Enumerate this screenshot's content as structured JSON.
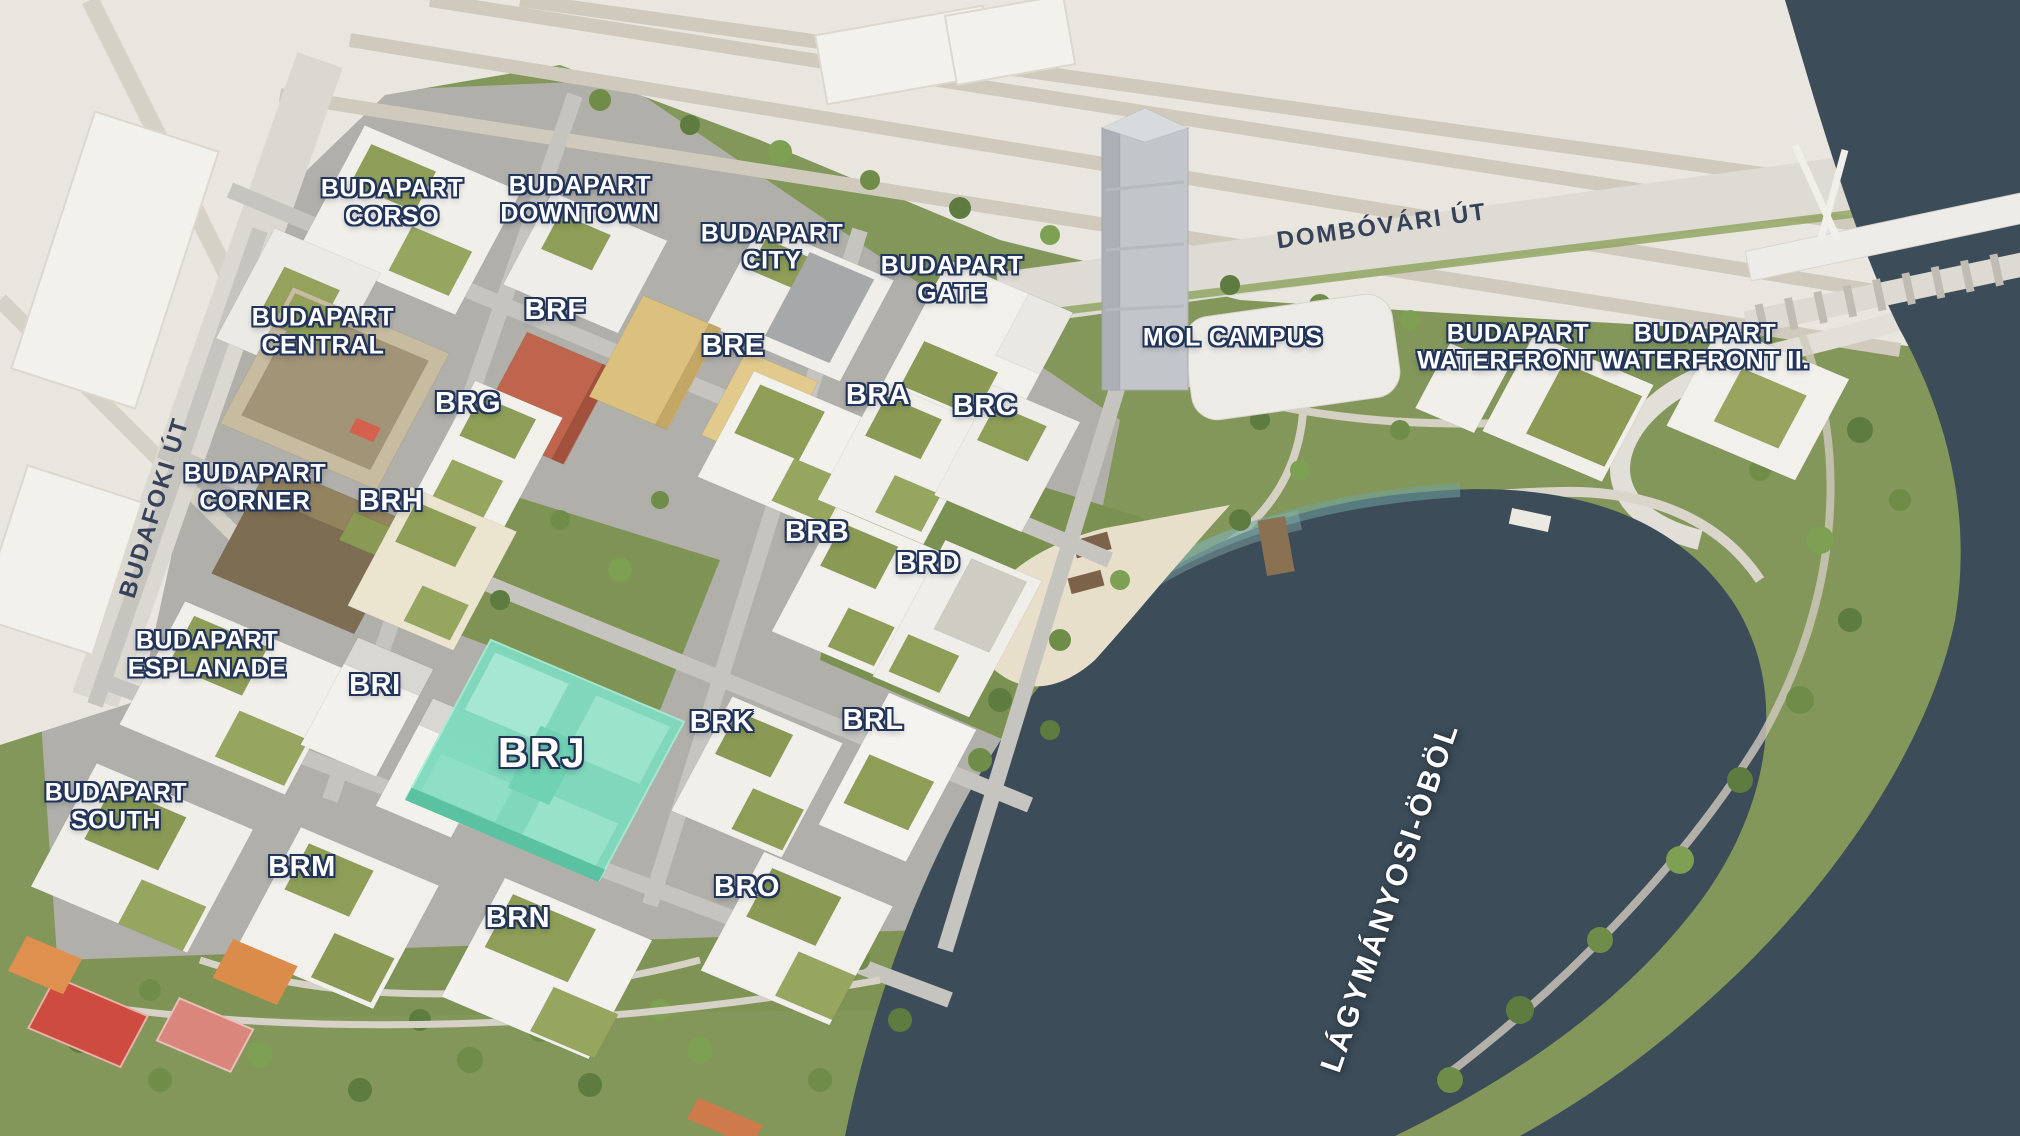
{
  "scene": {
    "type": "aerial-3d-masterplan-render",
    "development": "BudaPart",
    "highlighted_block": "BRJ",
    "colors": {
      "highlight_building": "#7edabd",
      "water": "#3c4c59",
      "park_green": "#83975a",
      "label_text": "#ffffff",
      "label_outline": "#22345a",
      "road_label_text": "#36425a",
      "sand_beach": "#e8dfca",
      "sport_court_red": "#ce4b3f"
    }
  },
  "labels": [
    {
      "id": "budapart-corso",
      "text": "BUDAPART CORSO",
      "lines": [
        "BUDAPART",
        "CORSO"
      ],
      "x_pct": 19.41,
      "y_pct": 17.87,
      "rot": 0,
      "type": "district"
    },
    {
      "id": "budapart-downtown",
      "text": "BUDAPART DOWNTOWN",
      "lines": [
        "BUDAPART",
        "DOWNTOWN"
      ],
      "x_pct": 28.71,
      "y_pct": 17.61,
      "rot": 0,
      "type": "district"
    },
    {
      "id": "budapart-city",
      "text": "BUDAPART CITY",
      "lines": [
        "BUDAPART",
        "CITY"
      ],
      "x_pct": 38.22,
      "y_pct": 21.83,
      "rot": 0,
      "type": "district"
    },
    {
      "id": "budapart-gate",
      "text": "BUDAPART GATE",
      "lines": [
        "BUDAPART",
        "GATE"
      ],
      "x_pct": 47.13,
      "y_pct": 24.65,
      "rot": 0,
      "type": "district"
    },
    {
      "id": "mol-campus",
      "text": "MOL CAMPUS",
      "lines": [
        "MOL CAMPUS"
      ],
      "x_pct": 61.04,
      "y_pct": 29.75,
      "rot": 0,
      "type": "landmark"
    },
    {
      "id": "budapart-waterfront-1",
      "text": "BUDAPART WATERFRONT I.",
      "lines": [
        "BUDAPART",
        "WATERFRONT I."
      ],
      "x_pct": 75.15,
      "y_pct": 30.63,
      "rot": 0,
      "type": "district"
    },
    {
      "id": "budapart-waterfront-2",
      "text": "BUDAPART WATERFRONT II.",
      "lines": [
        "BUDAPART",
        "WATERFRONT II."
      ],
      "x_pct": 84.41,
      "y_pct": 30.63,
      "rot": 0,
      "type": "district"
    },
    {
      "id": "dombovari-ut",
      "text": "DOMBÓVÁRI ÚT",
      "lines": [
        "DOMBÓVÁRI ÚT"
      ],
      "x_pct": 68.42,
      "y_pct": 19.98,
      "rot": -8,
      "type": "road"
    },
    {
      "id": "budafoki-ut",
      "text": "BUDAFOKI ÚT",
      "lines": [
        "BUDAFOKI ÚT"
      ],
      "x_pct": 7.67,
      "y_pct": 44.72,
      "rot": -73,
      "type": "road"
    },
    {
      "id": "budapart-central",
      "text": "BUDAPART CENTRAL",
      "lines": [
        "BUDAPART",
        "CENTRAL"
      ],
      "x_pct": 15.99,
      "y_pct": 29.23,
      "rot": 0,
      "type": "district"
    },
    {
      "id": "brf",
      "text": "BRF",
      "lines": [
        "BRF"
      ],
      "x_pct": 27.48,
      "y_pct": 27.38,
      "rot": 0,
      "type": "block"
    },
    {
      "id": "bre",
      "text": "BRE",
      "lines": [
        "BRE"
      ],
      "x_pct": 36.29,
      "y_pct": 30.55,
      "rot": 0,
      "type": "block"
    },
    {
      "id": "brg",
      "text": "BRG",
      "lines": [
        "BRG"
      ],
      "x_pct": 23.17,
      "y_pct": 35.56,
      "rot": 0,
      "type": "block"
    },
    {
      "id": "bra",
      "text": "BRA",
      "lines": [
        "BRA"
      ],
      "x_pct": 43.47,
      "y_pct": 34.86,
      "rot": 0,
      "type": "block"
    },
    {
      "id": "brc",
      "text": "BRC",
      "lines": [
        "BRC"
      ],
      "x_pct": 48.76,
      "y_pct": 35.83,
      "rot": 0,
      "type": "block"
    },
    {
      "id": "budapart-corner",
      "text": "BUDAPART CORNER",
      "lines": [
        "BUDAPART",
        "CORNER"
      ],
      "x_pct": 12.62,
      "y_pct": 42.96,
      "rot": 0,
      "type": "district"
    },
    {
      "id": "brh",
      "text": "BRH",
      "lines": [
        "BRH"
      ],
      "x_pct": 19.36,
      "y_pct": 44.19,
      "rot": 0,
      "type": "block"
    },
    {
      "id": "brb",
      "text": "BRB",
      "lines": [
        "BRB"
      ],
      "x_pct": 40.45,
      "y_pct": 46.92,
      "rot": 0,
      "type": "block"
    },
    {
      "id": "brd",
      "text": "BRD",
      "lines": [
        "BRD"
      ],
      "x_pct": 45.94,
      "y_pct": 49.65,
      "rot": 0,
      "type": "block"
    },
    {
      "id": "budapart-esplanade",
      "text": "BUDAPART ESPLANADE",
      "lines": [
        "BUDAPART",
        "ESPLANADE"
      ],
      "x_pct": 10.25,
      "y_pct": 57.66,
      "rot": 0,
      "type": "district"
    },
    {
      "id": "bri",
      "text": "BRI",
      "lines": [
        "BRI"
      ],
      "x_pct": 18.56,
      "y_pct": 60.39,
      "rot": 0,
      "type": "block"
    },
    {
      "id": "brj",
      "text": "BRJ",
      "lines": [
        "BRJ"
      ],
      "x_pct": 26.83,
      "y_pct": 66.29,
      "rot": 0,
      "type": "block-highlight"
    },
    {
      "id": "brk",
      "text": "BRK",
      "lines": [
        "BRK"
      ],
      "x_pct": 35.74,
      "y_pct": 63.64,
      "rot": 0,
      "type": "block"
    },
    {
      "id": "brl",
      "text": "BRL",
      "lines": [
        "BRL"
      ],
      "x_pct": 43.22,
      "y_pct": 63.47,
      "rot": 0,
      "type": "block"
    },
    {
      "id": "budapart-south",
      "text": "BUDAPART SOUTH",
      "lines": [
        "BUDAPART",
        "SOUTH"
      ],
      "x_pct": 5.74,
      "y_pct": 71.04,
      "rot": 0,
      "type": "district"
    },
    {
      "id": "brm",
      "text": "BRM",
      "lines": [
        "BRM"
      ],
      "x_pct": 14.95,
      "y_pct": 76.41,
      "rot": 0,
      "type": "block"
    },
    {
      "id": "bro",
      "text": "BRO",
      "lines": [
        "BRO"
      ],
      "x_pct": 36.98,
      "y_pct": 78.17,
      "rot": 0,
      "type": "block"
    },
    {
      "id": "brn",
      "text": "BRN",
      "lines": [
        "BRN"
      ],
      "x_pct": 25.64,
      "y_pct": 80.9,
      "rot": 0,
      "type": "block"
    },
    {
      "id": "lagymanyosi-obol",
      "text": "LÁGYMÁNYOSI-ÖBÖL",
      "lines": [
        "LÁGYMÁNYOSI-ÖBÖL"
      ],
      "x_pct": 68.81,
      "y_pct": 78.96,
      "rot": -71,
      "type": "water"
    }
  ]
}
